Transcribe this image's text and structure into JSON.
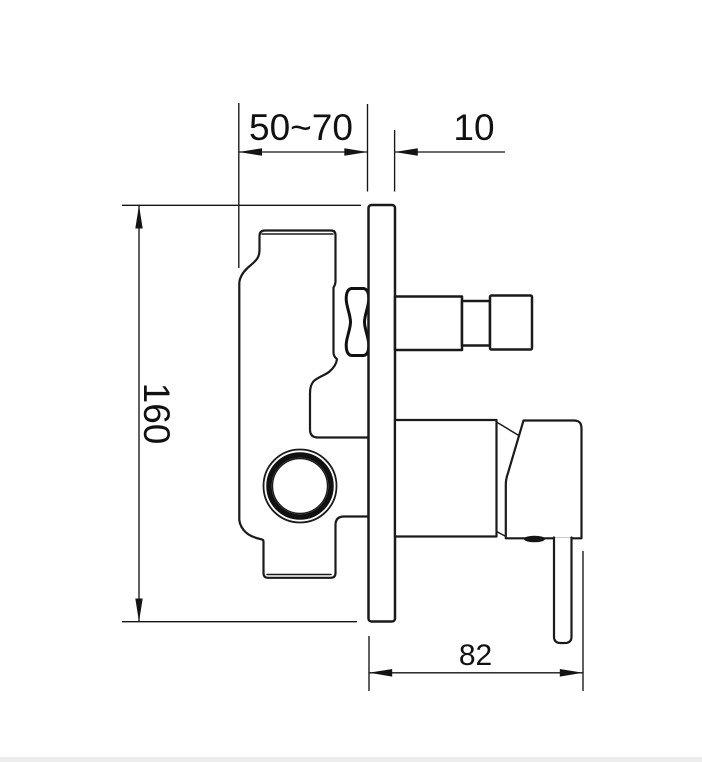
{
  "drawing": {
    "type": "technical-dimension-drawing",
    "subject": "concealed-shower-mixer-valve-side-view",
    "dimensions": {
      "depth_range": {
        "label": "50~70",
        "value_min": 50,
        "value_max": 70
      },
      "plate_thickness": {
        "label": "10",
        "value": 10
      },
      "plate_height": {
        "label": "160",
        "value": 160
      },
      "handle_projection": {
        "label": "82",
        "value": 82
      }
    },
    "colors": {
      "background": "#ffffff",
      "part_line": "#1a1a1a",
      "dimension_line": "#141414",
      "text": "#111111",
      "bottom_strip": "#ededed"
    }
  }
}
